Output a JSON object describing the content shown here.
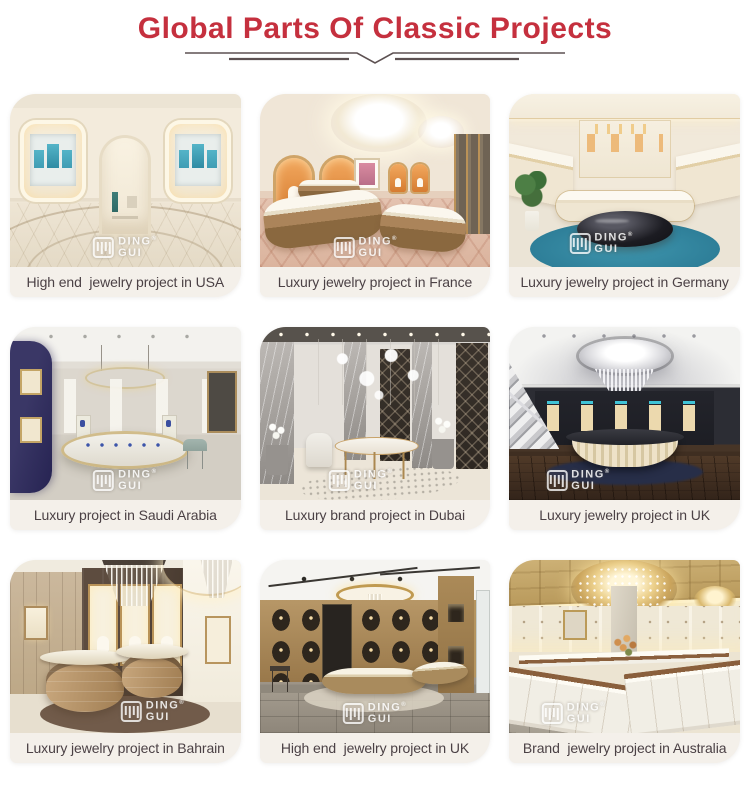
{
  "header": {
    "title": "Global Parts Of Classic Projects",
    "title_color": "#c5303e",
    "divider_color": "#5d5152"
  },
  "watermark": {
    "line1": "DING",
    "line2": "GUI",
    "registered": "®"
  },
  "captions_style": {
    "text_color": "#4b4145",
    "bar_color": "#f4f0ea"
  },
  "projects": [
    {
      "id": "usa",
      "caption": "High end  jewelry project in USA",
      "palette": [
        "#f3ebdc",
        "#54b4c8",
        "#e7dcc5"
      ]
    },
    {
      "id": "france",
      "caption": "Luxury jewelry project in France",
      "palette": [
        "#f0e6d7",
        "#d67c31",
        "#ab845a"
      ]
    },
    {
      "id": "germany",
      "caption": "Luxury jewelry project in Germany",
      "palette": [
        "#f1e9da",
        "#2d7d97",
        "#1c1c22"
      ]
    },
    {
      "id": "saudi-arabia",
      "caption": "Luxury project in Saudi Arabia",
      "palette": [
        "#dcd7ce",
        "#262352",
        "#c4a566"
      ]
    },
    {
      "id": "dubai",
      "caption": "Luxury brand project in Dubai",
      "palette": [
        "#e4e0da",
        "#3a332c",
        "#ab8850"
      ]
    },
    {
      "id": "uk",
      "caption": "Luxury jewelry project in UK",
      "palette": [
        "#2c2d34",
        "#eee2c8",
        "#3f2e21"
      ]
    },
    {
      "id": "bahrain",
      "caption": "Luxury jewelry project in Bahrain",
      "palette": [
        "#cbb89d",
        "#44372d",
        "#c9a87e"
      ]
    },
    {
      "id": "uk-high-end",
      "caption": "High end  jewelry project in UK",
      "palette": [
        "#b4945f",
        "#2e261d",
        "#8f887c"
      ]
    },
    {
      "id": "australia",
      "caption": "Brand  jewelry project in Australia",
      "palette": [
        "#cdb176",
        "#f2efe6",
        "#8a5f3c"
      ]
    }
  ]
}
